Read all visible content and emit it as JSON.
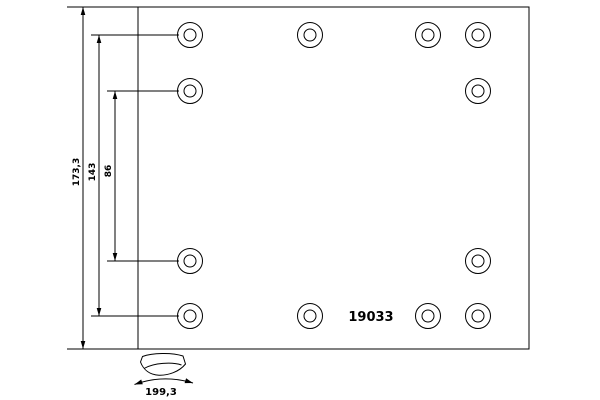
{
  "drawing": {
    "part_number": "19033",
    "dimensions": {
      "overall_height": "173,3",
      "outer_hole_spacing": "143",
      "inner_hole_spacing": "86",
      "arc_width": "199,3"
    },
    "line_color": "#000000",
    "background_color": "#ffffff",
    "holes": [
      {
        "x": 190,
        "y": 35
      },
      {
        "x": 310,
        "y": 35
      },
      {
        "x": 428,
        "y": 35
      },
      {
        "x": 478,
        "y": 35
      },
      {
        "x": 190,
        "y": 91
      },
      {
        "x": 478,
        "y": 91
      },
      {
        "x": 190,
        "y": 261
      },
      {
        "x": 478,
        "y": 261
      },
      {
        "x": 190,
        "y": 316
      },
      {
        "x": 310,
        "y": 316
      },
      {
        "x": 428,
        "y": 316
      },
      {
        "x": 478,
        "y": 316
      }
    ],
    "hole_outer_radius": 12.5,
    "hole_inner_radius": 6
  }
}
